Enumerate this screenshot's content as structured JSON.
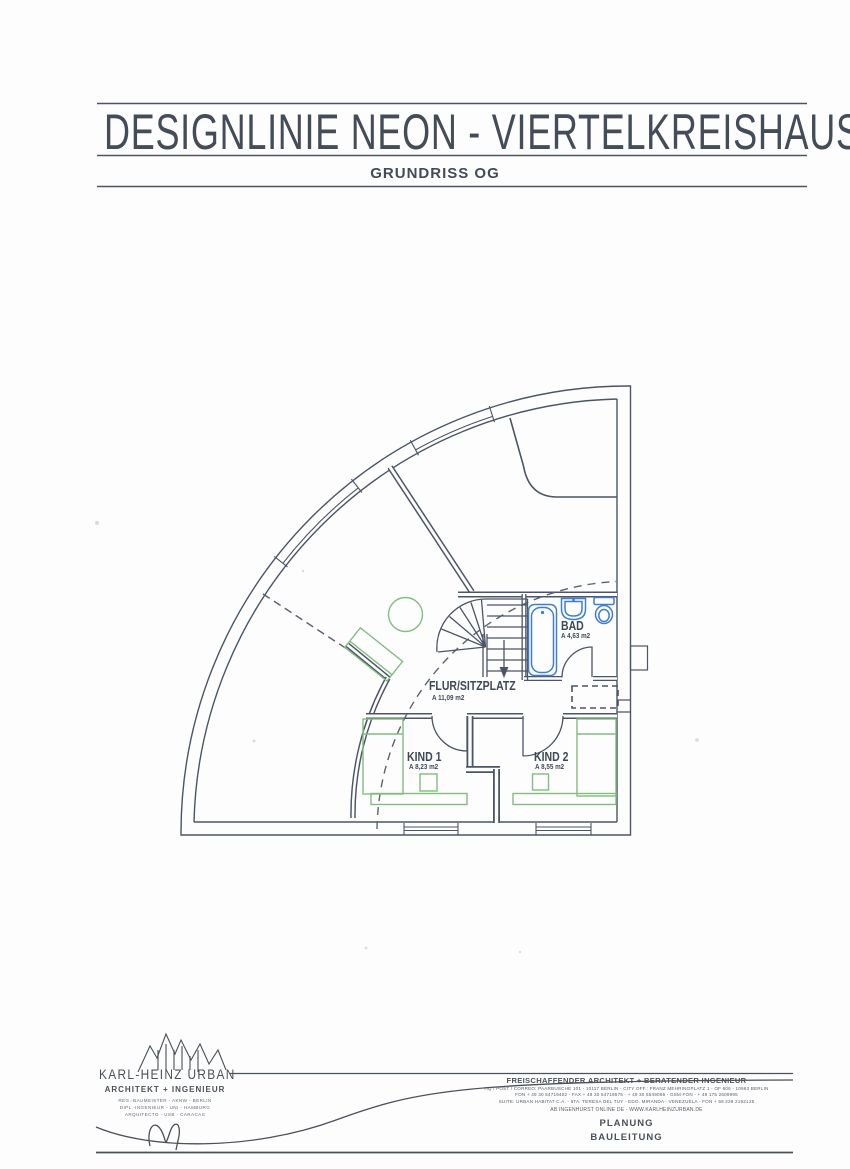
{
  "title_block": {
    "title": "DESIGNLINIE NEON - VIERTELKREISHAUS",
    "subtitle": "GRUNDRISS OG"
  },
  "plan": {
    "rooms": [
      {
        "name": "FLUR/SITZPLATZ",
        "area": "A 11,09 m2"
      },
      {
        "name": "BAD",
        "area": "A 4,63 m2"
      },
      {
        "name": "KIND 1",
        "area": "A 8,23 m2"
      },
      {
        "name": "KIND 2",
        "area": "A 8,55 m2"
      }
    ],
    "colors": {
      "ink": "#4b5566",
      "furniture_green": "#82bd7e",
      "fixture_blue": "#3f7ed2"
    }
  },
  "footer": {
    "logo": {
      "name": "KARL-HEINZ URBAN",
      "role": "ARCHITEKT + INGENIEUR",
      "sub1": "REG.-BAUMEISTER - AKNW - BERLIN",
      "sub2": "DIPL.-INGENIEUR - UNI - HAMBURG",
      "sub3": "ARQUITECTO - USB - CARACAS"
    },
    "right": {
      "heading": "FREISCHAFFENDER ARCHITEKT + BERATENDER INGENIEUR",
      "line1": "HQ / POST / CORREO: PAARBUSCHE 101 - 10117 BERLIN - CITY OFF.: FRANZ MEHRINGPLATZ 1 - OF 606 - 10963 BERLIN",
      "line2": "FON + 49 30 54719402 - FAX + 49 30 54719575 - + 49 30 5549065 - GSM FON - + 49 175 2609995",
      "line3": "SUITE: URBAN HABITAT C.A. - 5TA. TERESA DEL TUY - EDO. MIRANDA - VENEZUELA - FON + 58 239 2192125",
      "line4": "AB INGENHURST ONLINE DE  -  WWW.KARLHEINZURBAN.DE",
      "services": [
        "PLANUNG",
        "BAULEITUNG"
      ]
    }
  }
}
